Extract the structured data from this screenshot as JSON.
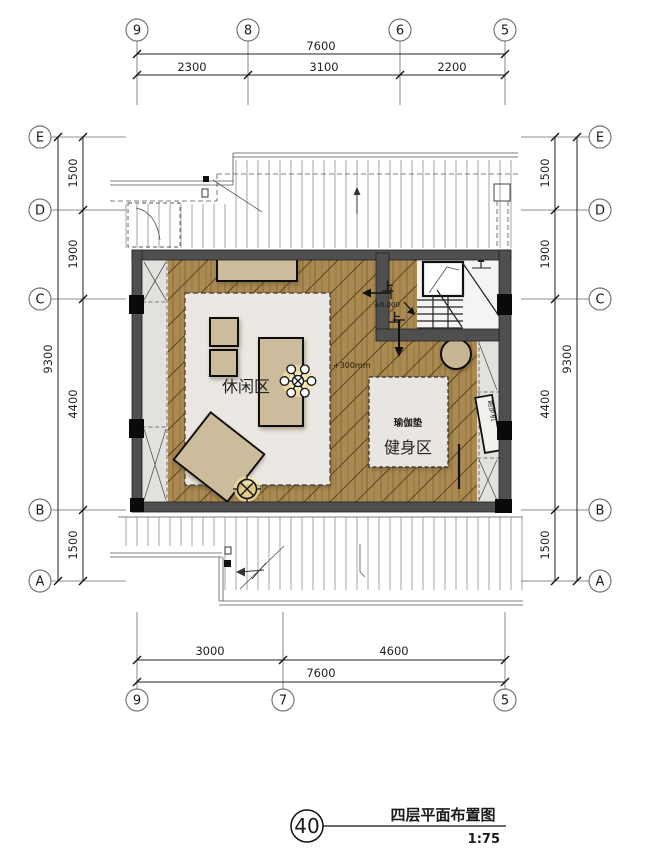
{
  "title_block": {
    "number": "40",
    "title": "四层平面布置图",
    "scale": "1:75"
  },
  "grid": {
    "top": [
      "9",
      "8",
      "6",
      "5"
    ],
    "bottom": [
      "9",
      "7",
      "5"
    ],
    "rows": [
      "E",
      "D",
      "C",
      "B",
      "A"
    ]
  },
  "dims": {
    "top_total": "7600",
    "top_segments": [
      "2300",
      "3100",
      "2200"
    ],
    "bottom_total": "7600",
    "bottom_segments": [
      "3000",
      "4600"
    ],
    "side_total": "9300",
    "side_segments": [
      "1500",
      "1900",
      "4400",
      "1500"
    ]
  },
  "labels": {
    "leisure_area": "休闲区",
    "fitness_area": "健身区",
    "yoga_mat": "瑜伽垫",
    "floor_level": "+300mm",
    "stair_level": "±0.000",
    "stair_up_a": "上",
    "stair_up_b": "上",
    "treadmill": "跑步机"
  },
  "palette": {
    "wood": "#ab8a52",
    "wall": "#4f4f4f",
    "furniture": "#ccbc9b",
    "bay_window": "#e3e1dd",
    "rug": "#ebe8e3"
  }
}
